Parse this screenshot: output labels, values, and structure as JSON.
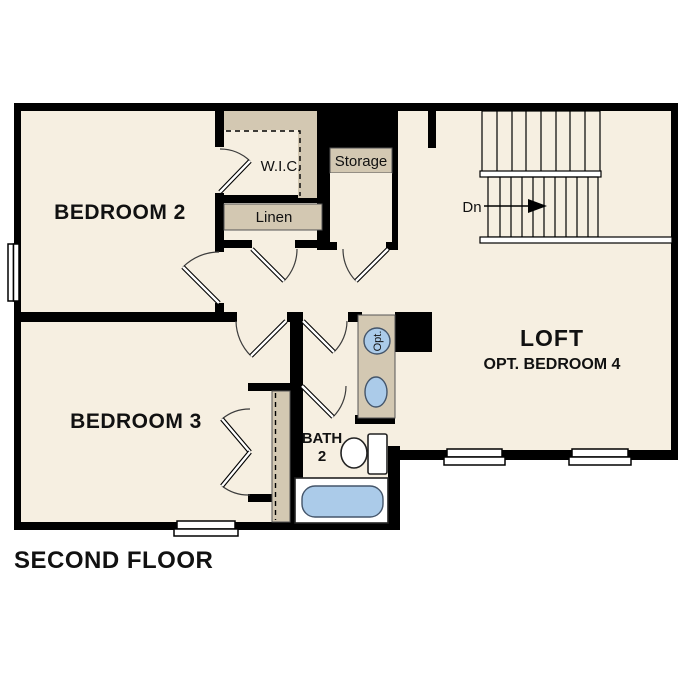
{
  "floor_plan": {
    "title": "SECOND FLOOR",
    "rooms": {
      "bedroom2": "BEDROOM 2",
      "bedroom3": "BEDROOM 3",
      "loft": "LOFT",
      "loft_option": "OPT. BEDROOM 4",
      "bath_line1": "BATH",
      "bath_line2": "2",
      "wic": "W.I.C.",
      "storage": "Storage",
      "linen": "Linen"
    },
    "stairs": {
      "down_label": "Dn"
    },
    "fixtures": {
      "optional_sink_label": "Opt."
    },
    "colors": {
      "floor": "#f6efe1",
      "wall": "#000000",
      "shelf_tan": "#d3c8b2",
      "water_blue": "#abcbe9",
      "page": "#ffffff"
    }
  }
}
